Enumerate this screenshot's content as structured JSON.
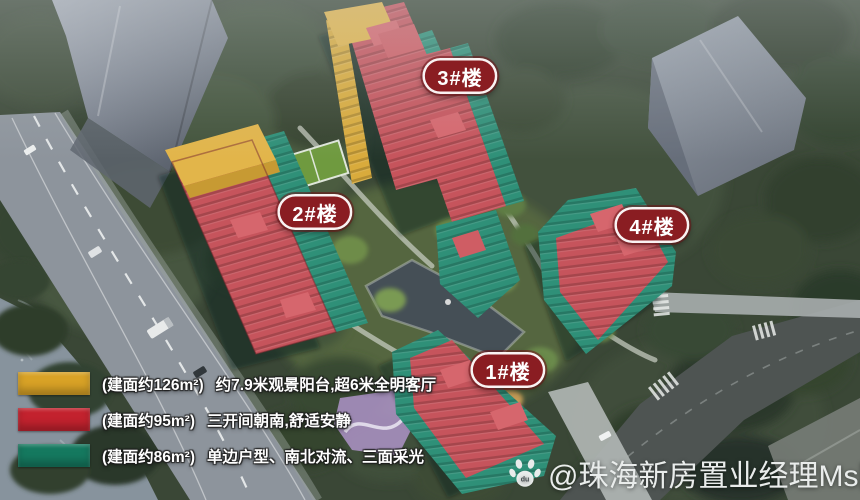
{
  "badges": [
    {
      "label": "3#楼"
    },
    {
      "label": "2#楼"
    },
    {
      "label": "4#楼"
    },
    {
      "label": "1#楼"
    }
  ],
  "legend": {
    "items": [
      {
        "color": "#d8a226",
        "area": "(建面约126m²)",
        "features": "约7.9米观景阳台,超6米全明客厅"
      },
      {
        "color": "#c3222e",
        "area": "(建面约95m²)",
        "features": "三开间朝南,舒适安静"
      },
      {
        "color": "#15795f",
        "area": "(建面约86m²)",
        "features": "单边户型、南北对流、三面采光"
      }
    ]
  },
  "watermark": {
    "handle": "@珠海新房置业经理Ms陈"
  },
  "colors": {
    "badge_bg": "#8a1d22",
    "building_red": "#c6545c",
    "building_teal": "#2f9078",
    "building_yellow": "#e2b54a"
  }
}
